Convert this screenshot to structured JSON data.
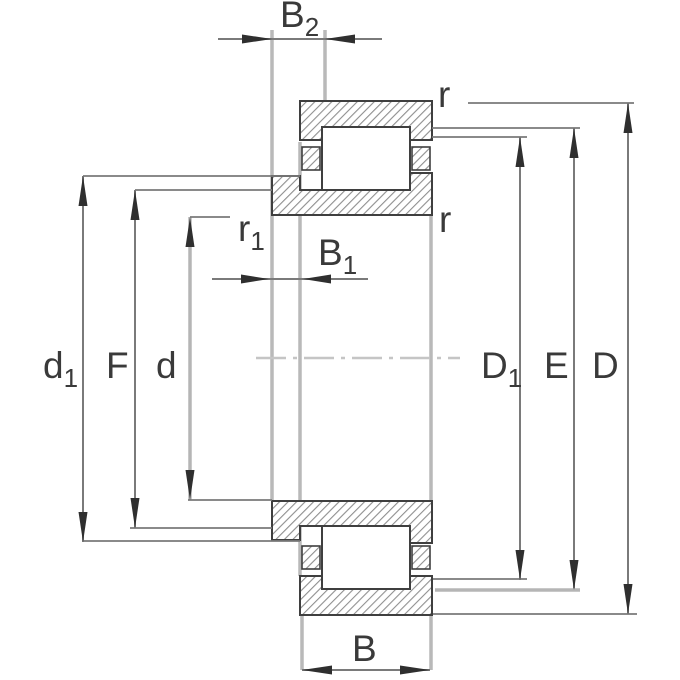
{
  "diagram": {
    "type": "bearing-cross-section-drawing",
    "labels": {
      "B2": {
        "base": "B",
        "sub": "2"
      },
      "B1": {
        "base": "B",
        "sub": "1"
      },
      "B": {
        "base": "B"
      },
      "d1": {
        "base": "d",
        "sub": "1"
      },
      "F": {
        "base": "F"
      },
      "d": {
        "base": "d"
      },
      "D1": {
        "base": "D",
        "sub": "1"
      },
      "E": {
        "base": "E"
      },
      "D": {
        "base": "D"
      },
      "r_top": {
        "base": "r"
      },
      "r_mid": {
        "base": "r"
      },
      "r1": {
        "base": "r",
        "sub": "1"
      }
    },
    "colors": {
      "background": "#ffffff",
      "outline": "#3f3f3f",
      "hatch": "#8f8f8f",
      "dim_line": "#7a7a7a",
      "light_line": "#b9b9b9",
      "centerline": "#c5c5c5",
      "arrow": "#2f2f2f",
      "text": "#3a3a3a"
    }
  }
}
